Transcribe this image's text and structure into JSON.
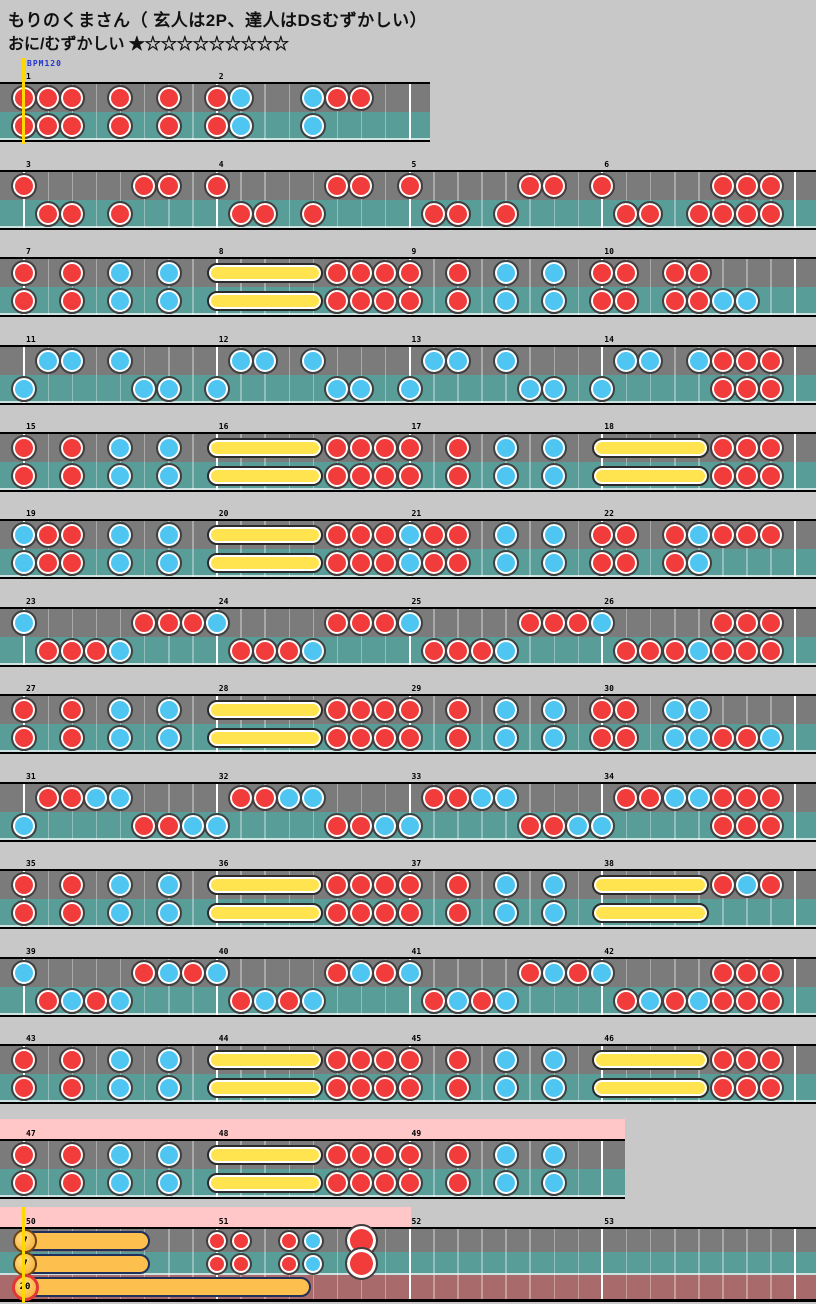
{
  "header": {
    "title": "もりのくまさん（ 玄人は2P、達人はDSむずかしい）",
    "difficulty": "おに/むずかしい",
    "stars": "★☆☆☆☆☆☆☆☆☆"
  },
  "bpm_label": "BPM120",
  "colors": {
    "background": "#c8c8c8",
    "lane_upper": "#7b7b7b",
    "lane_lower": "#589d98",
    "lane_extra": "#a86a6a",
    "gogo_pink": "#ffc7c7",
    "don_red": "#f23c3c",
    "ka_blue": "#4fc6f2",
    "roll_yellow": "#ffe44f",
    "balloon_orange": "#fdbf4e",
    "start_line_yellow": "#ffd800",
    "bpm_blue": "#2233cc",
    "barline_white": "#ffffff",
    "border_black": "#000000"
  },
  "chart": {
    "note_legend": {
      "d": "don (red)",
      "k": "ka (blue)",
      "D": "big don (red)"
    },
    "rows": [
      {
        "y": 82,
        "w": 430,
        "measures": [
          {
            "n": 1,
            "upper": [
              "d0",
              "d1",
              "d2",
              "d4",
              "d6"
            ],
            "lower": [
              "d0",
              "d1",
              "d2",
              "d4",
              "d6"
            ]
          },
          {
            "n": 2,
            "upper": [
              "d0",
              "k1",
              "k4",
              "d5",
              "d6"
            ],
            "lower": [
              "d0",
              "k1",
              "k4"
            ]
          }
        ]
      },
      {
        "y": 170,
        "w": 816,
        "measures": [
          {
            "n": 3,
            "upper": [
              "d0",
              "d5",
              "d6"
            ],
            "lower": [
              "d1",
              "d2",
              "d4"
            ]
          },
          {
            "n": 4,
            "upper": [
              "d0",
              "d5",
              "d6"
            ],
            "lower": [
              "d1",
              "d2",
              "d4"
            ]
          },
          {
            "n": 5,
            "upper": [
              "d0",
              "d5",
              "d6"
            ],
            "lower": [
              "d1",
              "d2",
              "d4"
            ]
          },
          {
            "n": 6,
            "upper": [
              "d0",
              "d5",
              "d6",
              "d7"
            ],
            "lower": [
              "d1",
              "d2",
              "d4",
              "d5",
              "d6",
              "d7"
            ]
          }
        ]
      },
      {
        "y": 257,
        "w": 816,
        "measures": [
          {
            "n": 7,
            "upper": [
              "d0",
              "d2",
              "k4",
              "k6"
            ],
            "lower": [
              "d0",
              "d2",
              "k4",
              "k6"
            ]
          },
          {
            "n": 8,
            "roll": "both",
            "upper": [
              "d5",
              "d6",
              "d7"
            ],
            "lower": [
              "d5",
              "d6",
              "d7"
            ]
          },
          {
            "n": 9,
            "upper": [
              "d0",
              "d2",
              "k4",
              "k6"
            ],
            "lower": [
              "d0",
              "d2",
              "k4",
              "k6"
            ]
          },
          {
            "n": 10,
            "upper": [
              "d0",
              "d1",
              "d3",
              "d4"
            ],
            "lower": [
              "d0",
              "d1",
              "d3",
              "d4",
              "k5",
              "k6"
            ]
          }
        ]
      },
      {
        "y": 345,
        "w": 816,
        "measures": [
          {
            "n": 11,
            "upper": [
              "k1",
              "k2",
              "k4"
            ],
            "lower": [
              "k0",
              "k5",
              "k6"
            ]
          },
          {
            "n": 12,
            "upper": [
              "k1",
              "k2",
              "k4"
            ],
            "lower": [
              "k0",
              "k5",
              "k6"
            ]
          },
          {
            "n": 13,
            "upper": [
              "k1",
              "k2",
              "k4"
            ],
            "lower": [
              "k0",
              "k5",
              "k6"
            ]
          },
          {
            "n": 14,
            "upper": [
              "k1",
              "k2",
              "k4",
              "d5",
              "d6",
              "d7"
            ],
            "lower": [
              "k0",
              "d5",
              "d6",
              "d7"
            ]
          }
        ]
      },
      {
        "y": 432,
        "w": 816,
        "measures": [
          {
            "n": 15,
            "upper": [
              "d0",
              "d2",
              "k4",
              "k6"
            ],
            "lower": [
              "d0",
              "d2",
              "k4",
              "k6"
            ]
          },
          {
            "n": 16,
            "roll": "both",
            "upper": [
              "d5",
              "d6",
              "d7"
            ],
            "lower": [
              "d5",
              "d6",
              "d7"
            ]
          },
          {
            "n": 17,
            "upper": [
              "d0",
              "d2",
              "k4",
              "k6"
            ],
            "lower": [
              "d0",
              "d2",
              "k4",
              "k6"
            ]
          },
          {
            "n": 18,
            "roll": "both",
            "upper": [
              "d5",
              "d6",
              "d7"
            ],
            "lower": [
              "d5",
              "d6",
              "d7"
            ]
          }
        ]
      },
      {
        "y": 519,
        "w": 816,
        "measures": [
          {
            "n": 19,
            "upper": [
              "k0",
              "d1",
              "d2",
              "k4",
              "k6"
            ],
            "lower": [
              "k0",
              "d1",
              "d2",
              "k4",
              "k6"
            ]
          },
          {
            "n": 20,
            "roll": "both",
            "upper": [
              "d5",
              "d6",
              "d7"
            ],
            "lower": [
              "d5",
              "d6",
              "d7"
            ]
          },
          {
            "n": 21,
            "upper": [
              "k0",
              "d1",
              "d2",
              "k4",
              "k6"
            ],
            "lower": [
              "k0",
              "d1",
              "d2",
              "k4",
              "k6"
            ]
          },
          {
            "n": 22,
            "upper": [
              "d0",
              "d1",
              "d3",
              "k4",
              "d5",
              "d6",
              "d7"
            ],
            "lower": [
              "d0",
              "d1",
              "d3",
              "k4"
            ]
          }
        ]
      },
      {
        "y": 607,
        "w": 816,
        "measures": [
          {
            "n": 23,
            "upper": [
              "k0",
              "d5",
              "d6",
              "d7"
            ],
            "lower": [
              "d1",
              "d2",
              "d3",
              "k4"
            ]
          },
          {
            "n": 24,
            "upper": [
              "k0",
              "d5",
              "d6",
              "d7"
            ],
            "lower": [
              "d1",
              "d2",
              "d3",
              "k4"
            ]
          },
          {
            "n": 25,
            "upper": [
              "k0",
              "d5",
              "d6",
              "d7"
            ],
            "lower": [
              "d1",
              "d2",
              "d3",
              "k4"
            ]
          },
          {
            "n": 26,
            "upper": [
              "k0",
              "d5",
              "d6",
              "d7"
            ],
            "lower": [
              "d1",
              "d2",
              "d3",
              "k4",
              "d5",
              "d6",
              "d7"
            ]
          }
        ]
      },
      {
        "y": 694,
        "w": 816,
        "measures": [
          {
            "n": 27,
            "upper": [
              "d0",
              "d2",
              "k4",
              "k6"
            ],
            "lower": [
              "d0",
              "d2",
              "k4",
              "k6"
            ]
          },
          {
            "n": 28,
            "roll": "both",
            "upper": [
              "d5",
              "d6",
              "d7"
            ],
            "lower": [
              "d5",
              "d6",
              "d7"
            ]
          },
          {
            "n": 29,
            "upper": [
              "d0",
              "d2",
              "k4",
              "k6"
            ],
            "lower": [
              "d0",
              "d2",
              "k4",
              "k6"
            ]
          },
          {
            "n": 30,
            "upper": [
              "d0",
              "d1",
              "k3",
              "k4"
            ],
            "lower": [
              "d0",
              "d1",
              "k3",
              "k4",
              "d5",
              "d6",
              "k7"
            ]
          }
        ]
      },
      {
        "y": 782,
        "w": 816,
        "measures": [
          {
            "n": 31,
            "upper": [
              "d1",
              "d2",
              "k3",
              "k4"
            ],
            "lower": [
              "k0",
              "d5",
              "d6",
              "k7"
            ]
          },
          {
            "n": 32,
            "upper": [
              "d1",
              "d2",
              "k3",
              "k4"
            ],
            "lower": [
              "k0",
              "d5",
              "d6",
              "k7"
            ]
          },
          {
            "n": 33,
            "upper": [
              "d1",
              "d2",
              "k3",
              "k4"
            ],
            "lower": [
              "k0",
              "d5",
              "d6",
              "k7"
            ]
          },
          {
            "n": 34,
            "upper": [
              "d1",
              "d2",
              "k3",
              "k4",
              "d5",
              "d6",
              "d7"
            ],
            "lower": [
              "k0",
              "d5",
              "d6",
              "d7"
            ]
          }
        ]
      },
      {
        "y": 869,
        "w": 816,
        "measures": [
          {
            "n": 35,
            "upper": [
              "d0",
              "d2",
              "k4",
              "k6"
            ],
            "lower": [
              "d0",
              "d2",
              "k4",
              "k6"
            ]
          },
          {
            "n": 36,
            "roll": "both",
            "upper": [
              "d5",
              "d6",
              "d7"
            ],
            "lower": [
              "d5",
              "d6",
              "d7"
            ]
          },
          {
            "n": 37,
            "upper": [
              "d0",
              "d2",
              "k4",
              "k6"
            ],
            "lower": [
              "d0",
              "d2",
              "k4",
              "k6"
            ]
          },
          {
            "n": 38,
            "roll": "both",
            "upper": [
              "d5",
              "k6",
              "d7"
            ],
            "lower": []
          }
        ]
      },
      {
        "y": 957,
        "w": 816,
        "measures": [
          {
            "n": 39,
            "upper": [
              "k0",
              "d5",
              "k6",
              "d7"
            ],
            "lower": [
              "d1",
              "k2",
              "d3",
              "k4"
            ]
          },
          {
            "n": 40,
            "upper": [
              "k0",
              "d5",
              "k6",
              "d7"
            ],
            "lower": [
              "d1",
              "k2",
              "d3",
              "k4"
            ]
          },
          {
            "n": 41,
            "upper": [
              "k0",
              "d5",
              "k6",
              "d7"
            ],
            "lower": [
              "d1",
              "k2",
              "d3",
              "k4"
            ]
          },
          {
            "n": 42,
            "upper": [
              "k0",
              "d5",
              "d6",
              "d7"
            ],
            "lower": [
              "d1",
              "k2",
              "d3",
              "k4",
              "d5",
              "d6",
              "d7"
            ]
          }
        ]
      },
      {
        "y": 1044,
        "w": 816,
        "measures": [
          {
            "n": 43,
            "upper": [
              "d0",
              "d2",
              "k4",
              "k6"
            ],
            "lower": [
              "d0",
              "d2",
              "k4",
              "k6"
            ]
          },
          {
            "n": 44,
            "roll": "both",
            "upper": [
              "d5",
              "d6",
              "d7"
            ],
            "lower": [
              "d5",
              "d6",
              "d7"
            ]
          },
          {
            "n": 45,
            "upper": [
              "d0",
              "d2",
              "k4",
              "k6"
            ],
            "lower": [
              "d0",
              "d2",
              "k4",
              "k6"
            ]
          },
          {
            "n": 46,
            "roll": "both",
            "upper": [
              "d5",
              "d6",
              "d7"
            ],
            "lower": [
              "d5",
              "d6",
              "d7"
            ]
          }
        ]
      },
      {
        "y": 1139,
        "w": 625,
        "pink": {
          "x": 0,
          "w": 625
        },
        "measures": [
          {
            "n": 47,
            "upper": [
              "d0",
              "d2",
              "k4",
              "k6"
            ],
            "lower": [
              "d0",
              "d2",
              "k4",
              "k6"
            ]
          },
          {
            "n": 48,
            "roll": "both",
            "upper": [
              "d5",
              "d6",
              "d7"
            ],
            "lower": [
              "d5",
              "d6",
              "d7"
            ]
          },
          {
            "n": 49,
            "upper": [
              "d0",
              "d2",
              "k4",
              "k6"
            ],
            "lower": [
              "d0",
              "d2",
              "k4",
              "k6"
            ]
          }
        ]
      },
      {
        "y": 1227,
        "w": 816,
        "lanes": 3,
        "pink": {
          "x": 0,
          "w": 411
        },
        "measures": [
          {
            "n": 50,
            "balloons": [
              {
                "lane": 0,
                "num": "7",
                "end_x": 150
              },
              {
                "lane": 1,
                "num": "7",
                "end_x": 150
              },
              {
                "lane": 2,
                "num": "20",
                "end_x": 311
              }
            ]
          },
          {
            "n": 51,
            "upper": [
              "d0",
              "d1",
              "d3",
              "k4",
              "D6"
            ],
            "lower": [
              "d0",
              "d1",
              "d3",
              "k4",
              "D6"
            ]
          },
          {
            "n": 52
          },
          {
            "n": 53
          }
        ]
      }
    ]
  }
}
